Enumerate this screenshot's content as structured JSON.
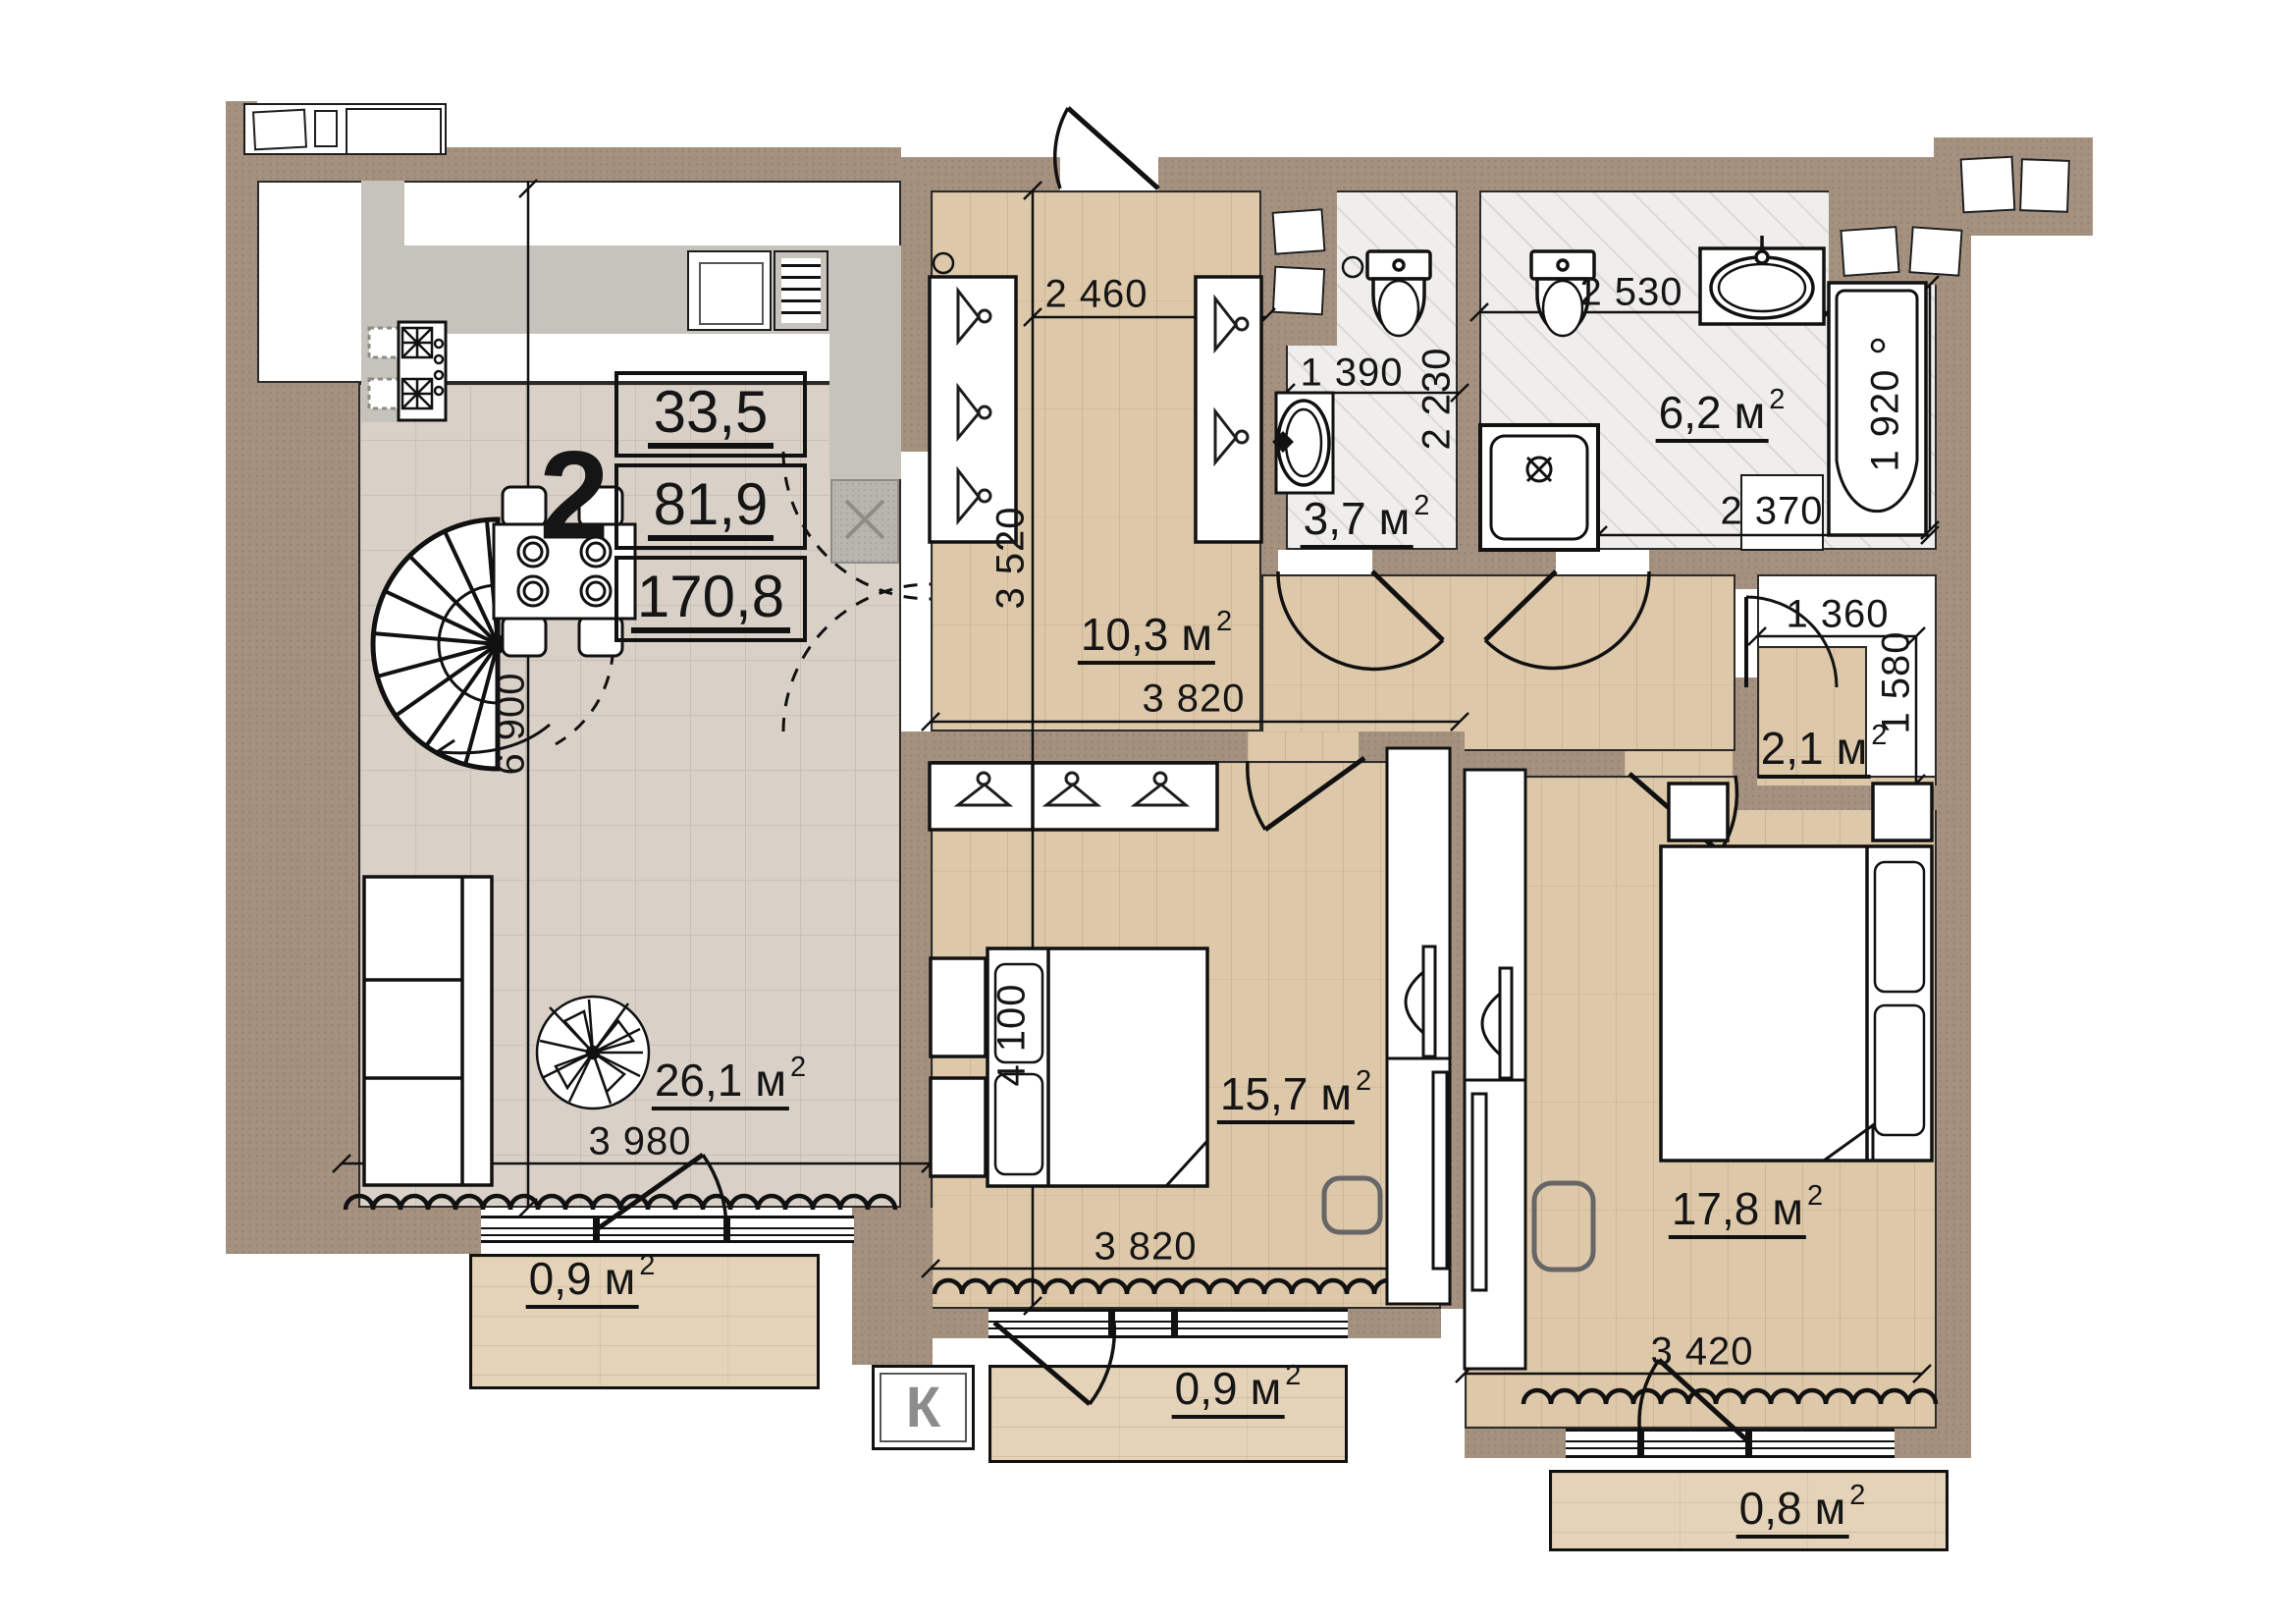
{
  "plan": {
    "unit": {
      "number": "2",
      "areas": [
        "33,5",
        "81,9",
        "170,8"
      ]
    },
    "rooms": {
      "living": {
        "area": "26,1",
        "unit": "м",
        "sup": "2"
      },
      "hallway": {
        "area": "10,3",
        "unit": "м",
        "sup": "2"
      },
      "bath_small": {
        "area": "3,7",
        "unit": "м",
        "sup": "2"
      },
      "bath_large": {
        "area": "6,2",
        "unit": "м",
        "sup": "2"
      },
      "closet": {
        "area": "2,1",
        "unit": "м",
        "sup": "2"
      },
      "bedroom_1": {
        "area": "15,7",
        "unit": "м",
        "sup": "2"
      },
      "bedroom_2": {
        "area": "17,8",
        "unit": "м",
        "sup": "2"
      },
      "balcony_left": {
        "area": "0,9",
        "unit": "м",
        "sup": "2"
      },
      "balcony_center": {
        "area": "0,9",
        "unit": "м",
        "sup": "2"
      },
      "balcony_right": {
        "area": "0,8",
        "unit": "м",
        "sup": "2"
      }
    },
    "dimensions": {
      "hall_entry_width": "2 460",
      "bath_small_width": "1 390",
      "bath_small_depth": "2 230",
      "bath_large_width": "2 530",
      "bath_large_depth": "1 920",
      "bath_large_bottom": "2 370",
      "hall_depth": "3 520",
      "hall_length": "3 820",
      "closet_width": "1 360",
      "closet_depth": "1 580",
      "living_height": "6 900",
      "living_width": "3 980",
      "bedroom_1_depth": "4 100",
      "bedroom_1_width": "3 820",
      "bedroom_2_width": "3 420"
    },
    "k_marker": "К",
    "colors": {
      "wall": "#a5917f",
      "wood_floor": "#ddc8aa",
      "tile_floor": "#d9d1c8",
      "bath_floor": "#efeeec",
      "line": "#1d1d1d"
    }
  }
}
